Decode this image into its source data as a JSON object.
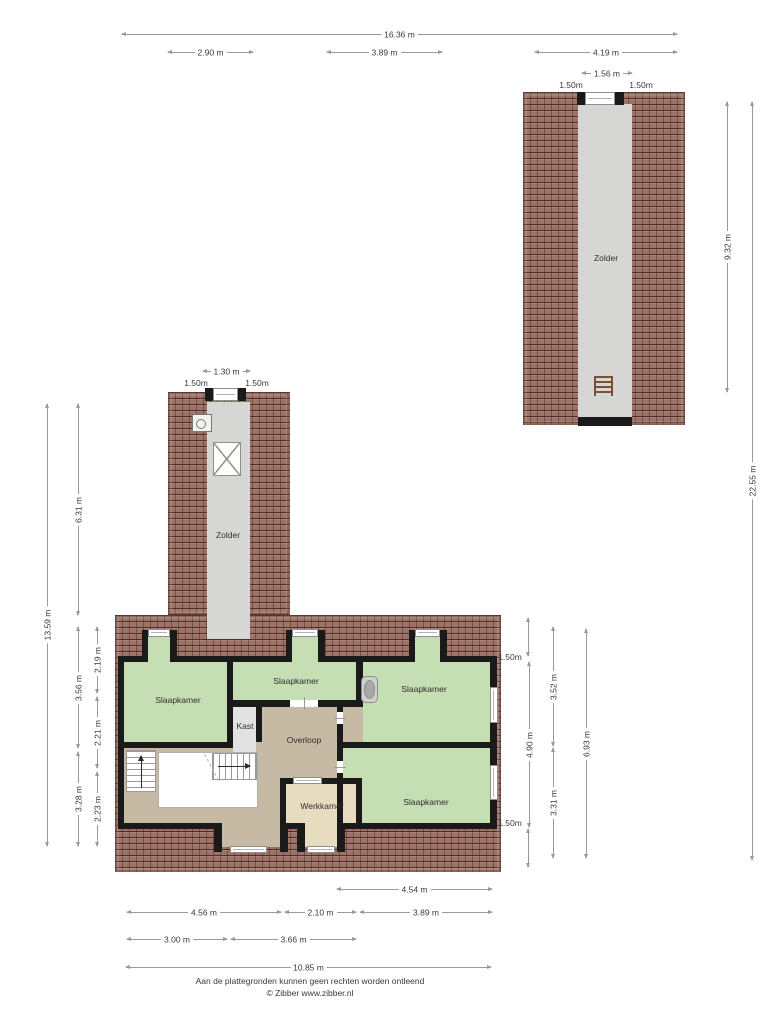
{
  "labels": {
    "zolder_barn": "Zolder",
    "zolder_tower": "Zolder",
    "slaapkamer_left": "Slaapkamer",
    "slaapkamer_mid": "Slaapkamer",
    "slaapkamer_right_top": "Slaapkamer",
    "slaapkamer_right_bottom": "Slaapkamer",
    "kast": "Kast",
    "overloop": "Overloop",
    "werkkamer": "Werkkamer"
  },
  "dimensions": {
    "top": {
      "total": "16.36 m",
      "w1": "2.90 m",
      "w2": "3.89 m",
      "w3": "4.19 m"
    },
    "barn": {
      "window": "1.56 m",
      "roof_left": "1.50m",
      "roof_right": "1.50m",
      "length": "9.32 m"
    },
    "right": {
      "total": "22.55 m",
      "roof_top": "1.50m",
      "h1": "3.52 m",
      "h2": "4.90 m",
      "h3": "3.31 m",
      "h4": "6.93 m",
      "roof_bottom": "1.50m"
    },
    "tower": {
      "window": "1.30 m",
      "roof_left": "1.50m",
      "roof_right": "1.50m"
    },
    "left": {
      "total": "13.59 m",
      "tower_length": "6.31 m",
      "h1": "3.56 m",
      "h2": "3.28 m",
      "h3": "2.19 m",
      "h4": "2.21 m",
      "h5": "2.23 m"
    },
    "bottom": {
      "w1": "4.54 m",
      "w2": "4.56 m",
      "w3": "2.10 m",
      "w4": "3.89 m",
      "w5": "3.00 m",
      "w6": "3.66 m",
      "total": "10.85 m"
    }
  },
  "footer": {
    "line1": "Aan de plattegronden kunnen geen rechten worden ontleend",
    "line2": "© Zibber www.zibber.nl"
  },
  "colors": {
    "roof": "#9d7367",
    "wall": "#1a1a1a",
    "green": "#c6deb3",
    "tan": "#c7baa4",
    "beige": "#e8dcc0",
    "gray": "#e2e2e2",
    "corridor": "#d6d6d4"
  }
}
